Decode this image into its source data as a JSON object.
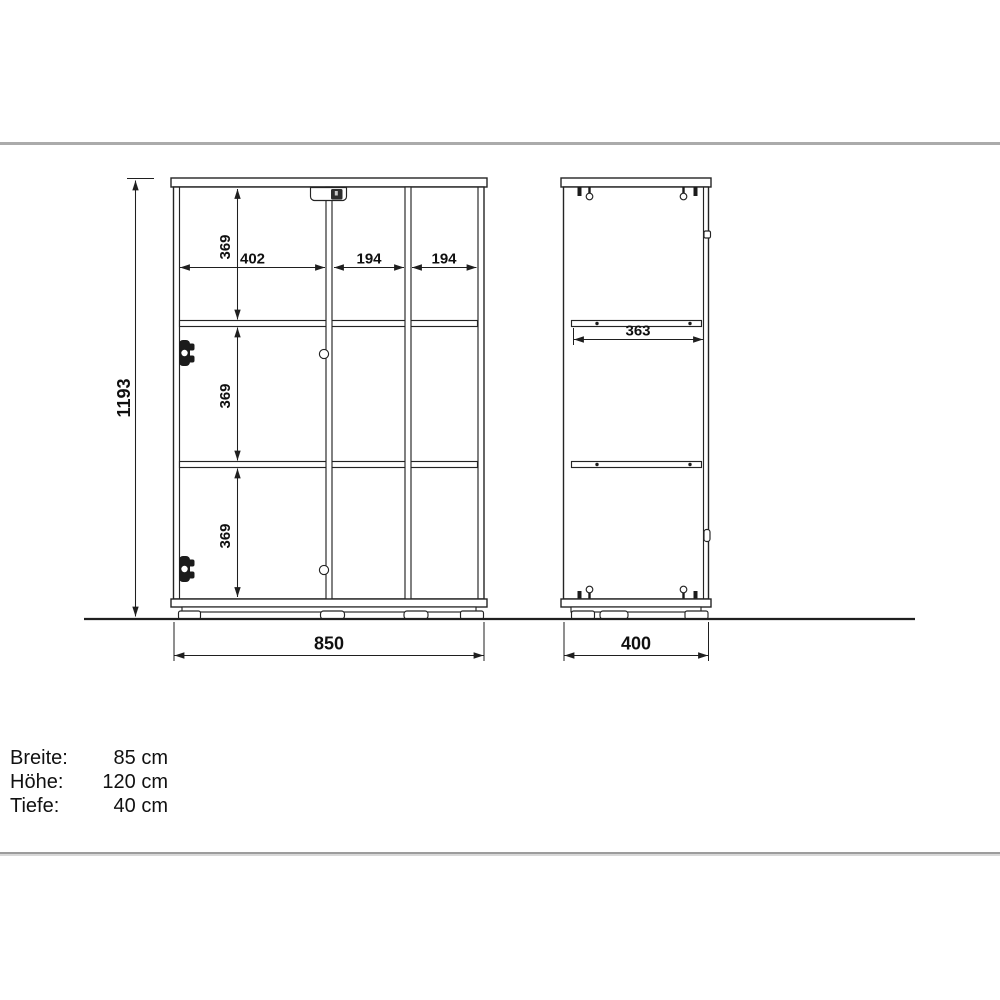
{
  "drawing": {
    "front_view": {
      "total_height": "1193",
      "total_width": "850",
      "row_top_height": "369",
      "row_middle_height": "369",
      "row_bottom_height": "369",
      "col_left_width": "402",
      "col_middle_width": "194",
      "col_right_width": "194"
    },
    "side_view": {
      "shelf_depth": "363",
      "total_depth": "400"
    },
    "line_color": "#1f1f1f"
  },
  "specs": {
    "rows": [
      {
        "label": "Breite:",
        "value": "85 cm"
      },
      {
        "label": "Höhe:",
        "value": "120 cm"
      },
      {
        "label": "Tiefe:",
        "value": "40 cm"
      }
    ]
  }
}
